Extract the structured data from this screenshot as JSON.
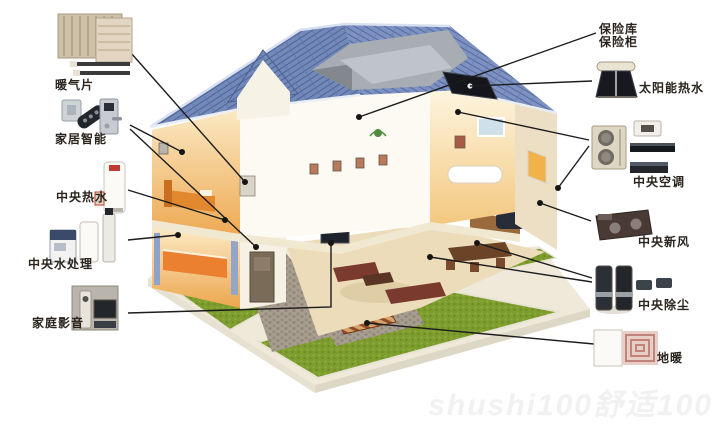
{
  "diagram": {
    "type": "smart-home-systems-cutaway",
    "watermark": "shushi100舒适100",
    "labels": {
      "radiator": "暖气片",
      "smart_home": "家居智能",
      "central_hot_water": "中央热水",
      "central_water_treatment": "中央水处理",
      "home_av": "家庭影音",
      "safe_line1": "保险库",
      "safe_line2": "保险柜",
      "solar_hot_water": "太阳能热水",
      "central_ac": "中央空调",
      "central_fresh_air": "中央新风",
      "central_dust_removal": "中央除尘",
      "floor_heating": "地暖"
    },
    "icons": [
      "radiator-panels-icon",
      "smart-lock-remote-icon",
      "water-heater-tank-icon",
      "water-treatment-units-icon",
      "av-equipment-icon",
      "solar-water-heater-icon",
      "ac-outdoor-indoor-units-icon",
      "fresh-air-ventilator-icon",
      "central-vacuum-units-icon",
      "floor-heating-coil-icon"
    ],
    "colors": {
      "roof_blue": "#7389bb",
      "roof_line": "#4d638f",
      "lawn_green": "#7e9d2f",
      "leader_line": "#1c1c1c",
      "wall_white": "#f7f2e6",
      "interior_warm": "#eda74f",
      "label_text": "#2a241e"
    }
  }
}
